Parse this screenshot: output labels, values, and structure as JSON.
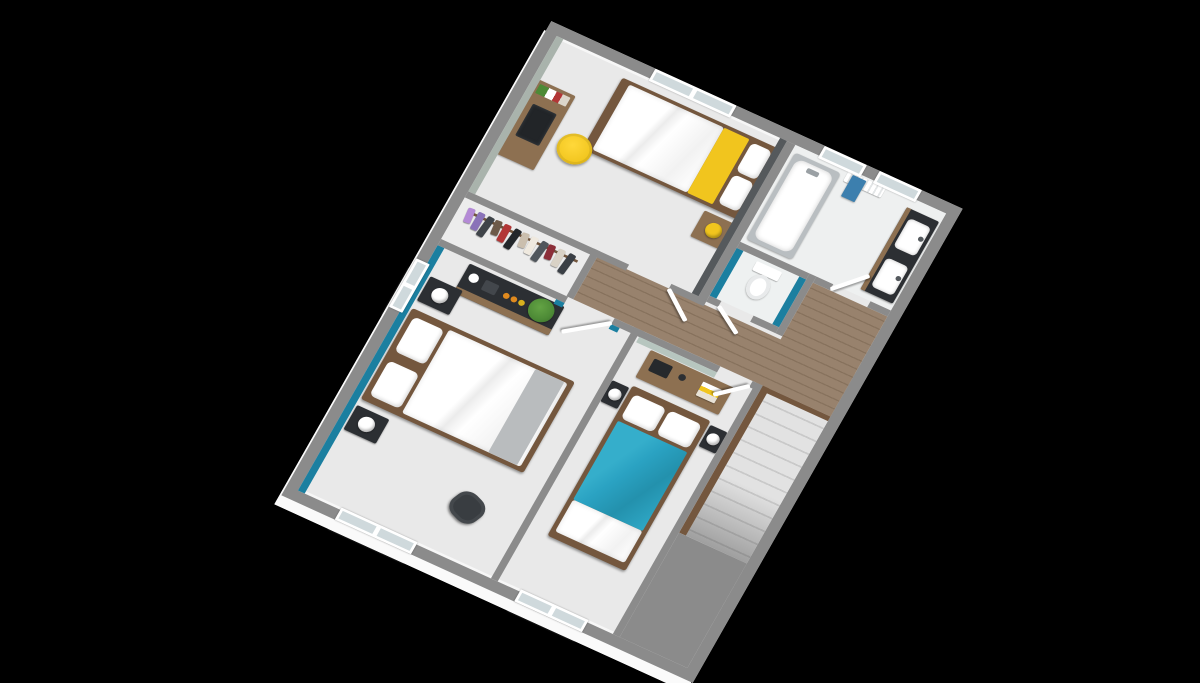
{
  "scene": {
    "type": "3d-floor-plan-render",
    "view": "axonometric-top-down, plan rotated clockwise",
    "background": "#000000",
    "storey": "upper floor with stairwell"
  },
  "colors": {
    "wall": "#8b8b8b",
    "wall_face": "#f7f7f7",
    "floor": "#e9e9e9",
    "bath_floor": "#eef0f0",
    "teal": "#1b7fa0",
    "teal_bright": "#2aa2c2",
    "yellow": "#f1c51e",
    "wood": "#8d7051",
    "wood_dark": "#74573e",
    "wood_floor": "#98826d",
    "wood_floor_seam": "#87725d",
    "dark_furniture": "#2c2f33",
    "accent_dark_wall": "#55595c",
    "sage_wall": "#a9b3ac",
    "sage_light": "#b7c6bf",
    "towel_blue": "#3c7fae",
    "plant_green": "#4d8a36",
    "fruit_orange": "#e08a1e",
    "gray_throw": "#b9bcbe",
    "stair_tread": "#e2e2e2"
  },
  "rooms": [
    {
      "id": "bedroom-1",
      "position": "top-left",
      "accent_walls": [
        "dark-gray-headboard-wall",
        "sage-left-wall"
      ],
      "furniture": [
        "single-bed-white-duvet-yellow-pillow",
        "wood-nightstand-yellow-lamp",
        "wood-desk",
        "black-laptop",
        "books",
        "yellow-chair"
      ],
      "windows": 1
    },
    {
      "id": "bathroom",
      "position": "top-right",
      "furniture": [
        "bathtub",
        "double-sink-vanity-dark-counter",
        "radiator-with-blue-towel"
      ],
      "windows": 2
    },
    {
      "id": "wc",
      "position": "center",
      "accent_walls": [
        "teal-partitions"
      ],
      "furniture": [
        "toilet"
      ],
      "windows": 0
    },
    {
      "id": "dressing",
      "position": "mid-left",
      "furniture": [
        "clothes-rail-with-hanging-garments"
      ],
      "windows": 0
    },
    {
      "id": "bedroom-2",
      "position": "bottom-left",
      "accent_walls": [
        "teal-left-wall"
      ],
      "furniture": [
        "double-bed-white-duvet-gray-throw",
        "black-nightstand-white-lamp",
        "black-nightstand-white-lamp",
        "dark-dresser-wood-base",
        "plant",
        "fruit-bowl",
        "vase",
        "black-chair"
      ],
      "windows": 2
    },
    {
      "id": "bedroom-3",
      "position": "bottom-right",
      "accent_walls": [
        "sage-console-wall"
      ],
      "furniture": [
        "double-bed-teal-blanket",
        "dark-nightstand-white-lamp",
        "dark-nightstand-white-lamp",
        "wood-console-with-books"
      ],
      "windows": 1
    },
    {
      "id": "landing-hallway",
      "position": "center",
      "floor": "wood-planks",
      "windows": 0
    },
    {
      "id": "stairwell",
      "position": "right",
      "floor": "stairs-down",
      "windows": 0
    }
  ],
  "dressing": {
    "clothes_colors": [
      "#b48ad6",
      "#8a72b8",
      "#3f4449",
      "#6d5a49",
      "#b23636",
      "#23272b",
      "#cbbfae",
      "#efe9df",
      "#50565c",
      "#8c2f39",
      "#d9d2c6",
      "#3a3f45"
    ]
  },
  "stairs": {
    "visible_steps": 11,
    "direction": "down",
    "stringer": "wood"
  }
}
